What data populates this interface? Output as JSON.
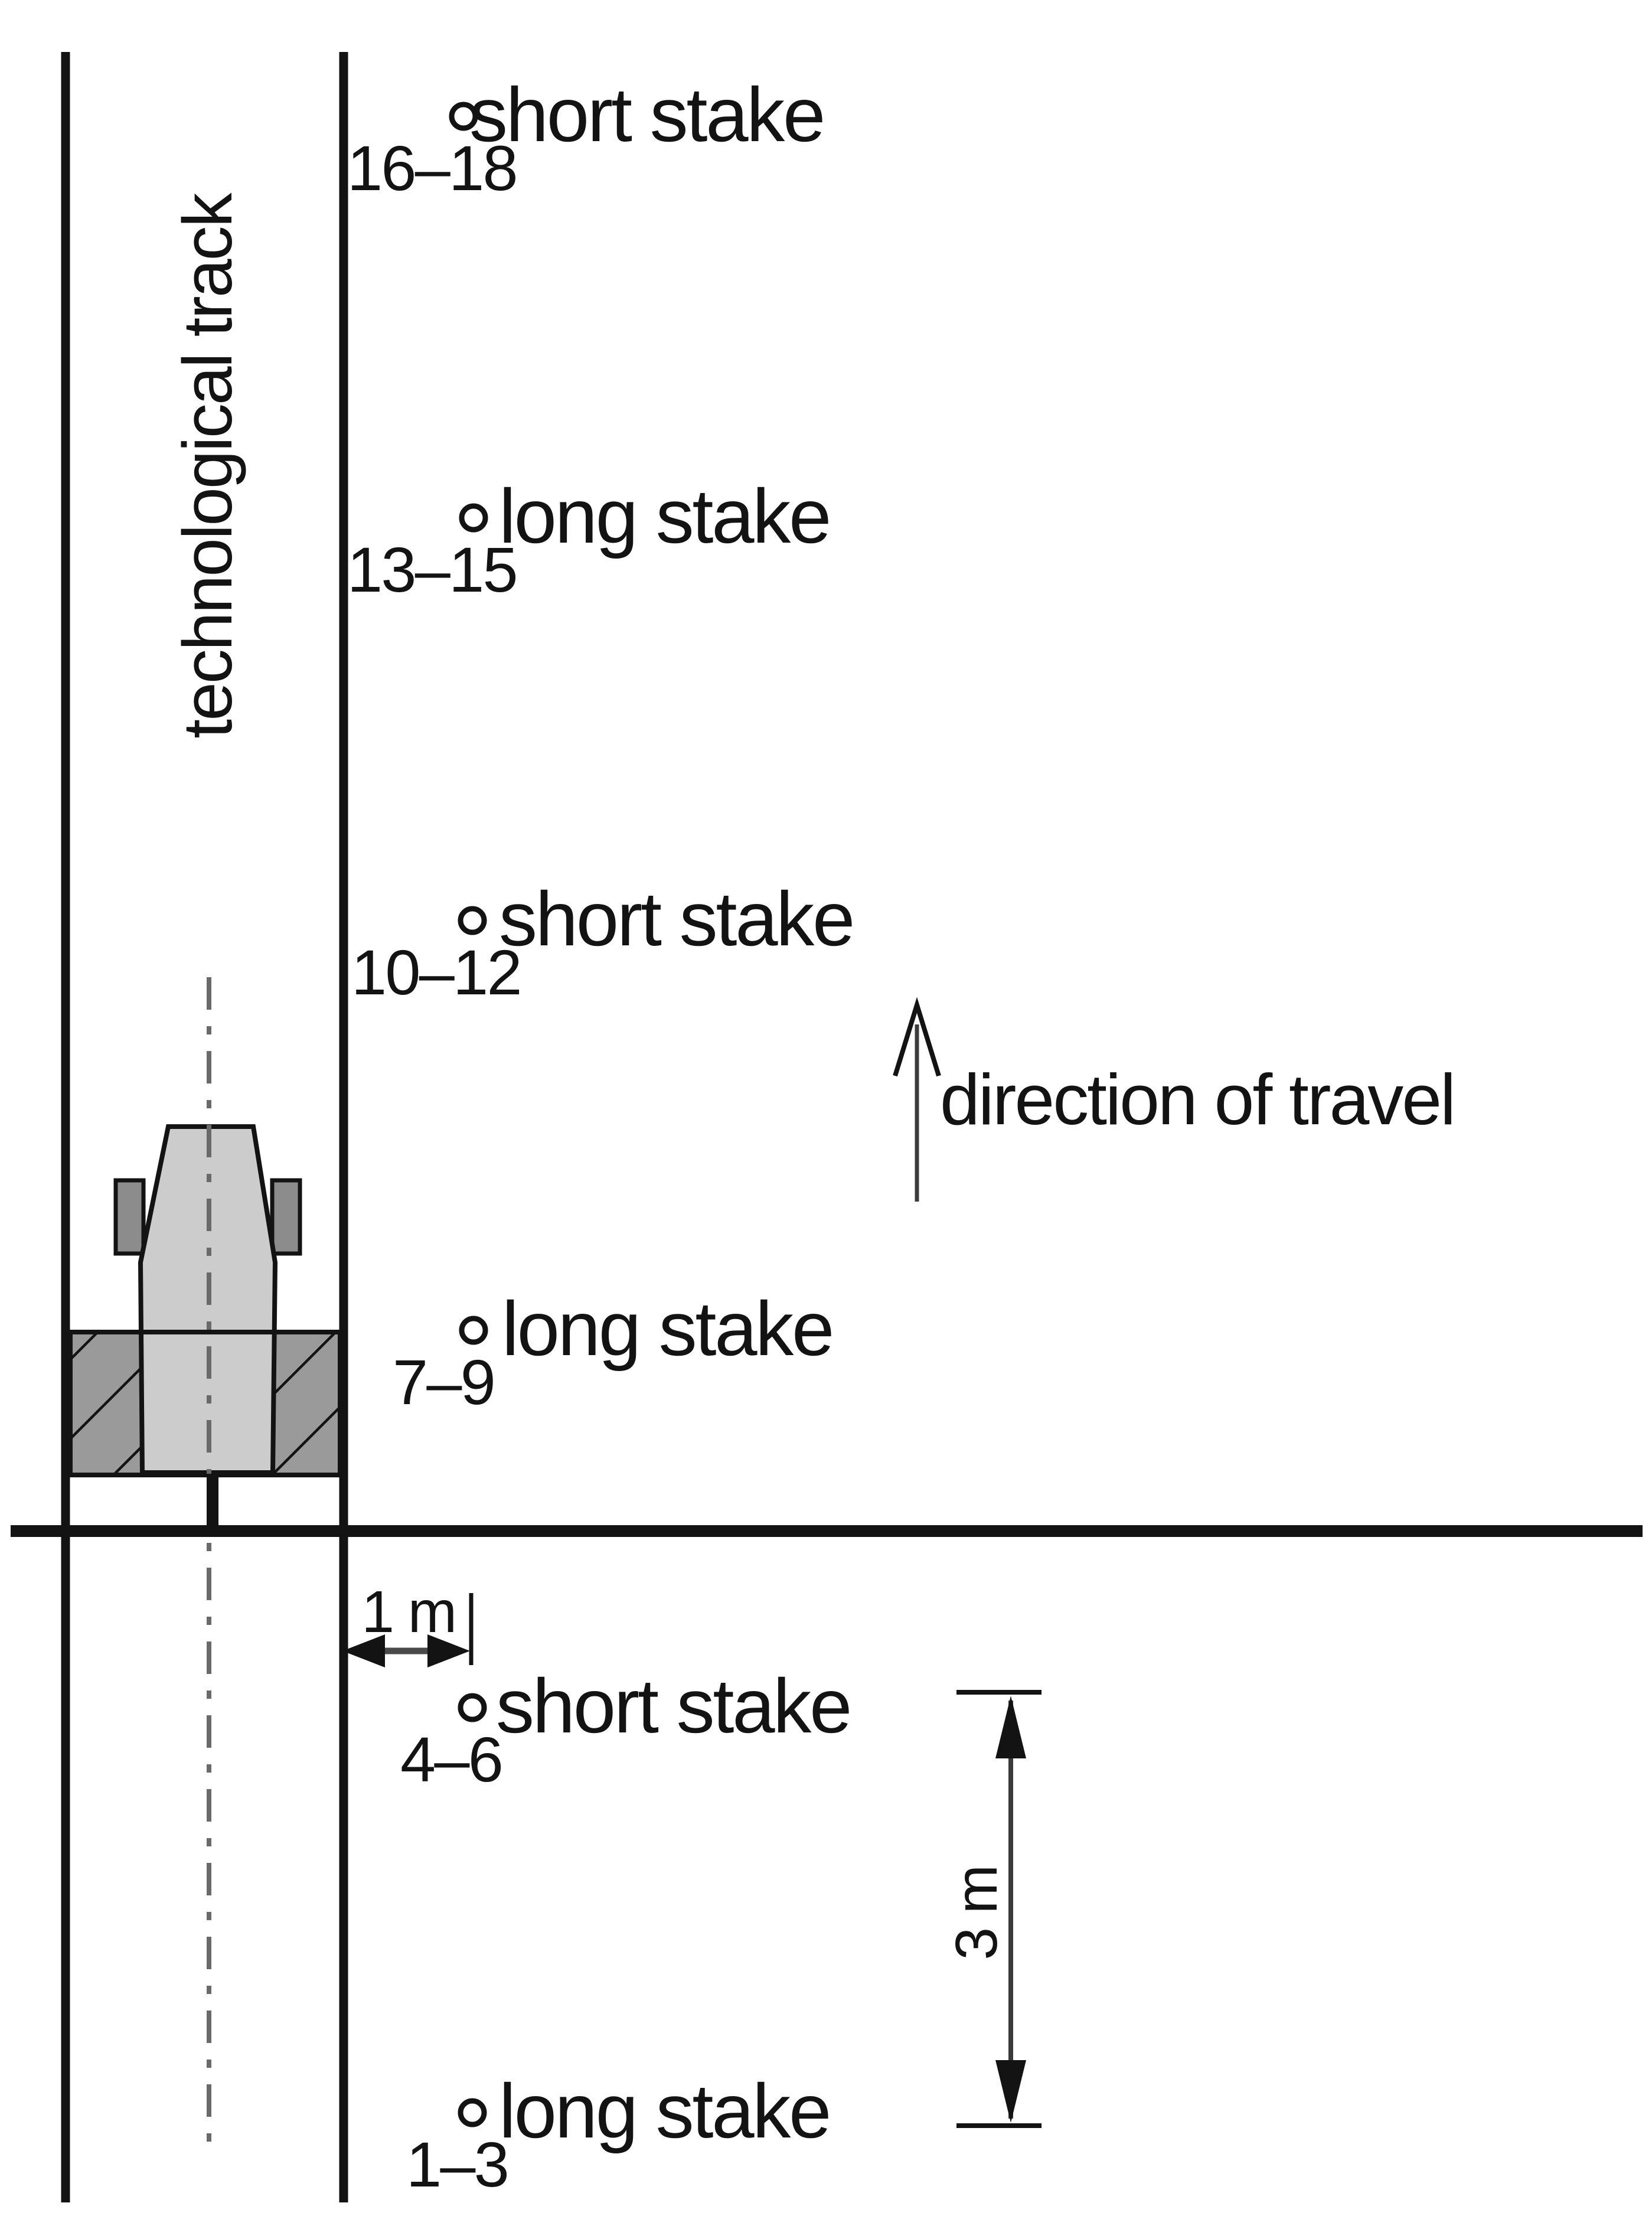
{
  "diagram": {
    "track_label": "technological track",
    "direction_label": "direction of travel",
    "dimension_1m_label": "1 m",
    "dimension_3m_label": "3 m",
    "stakes": [
      {
        "range": "16–18",
        "type": "short stake"
      },
      {
        "range": "13–15",
        "type": "long stake"
      },
      {
        "range": "10–12",
        "type": "short stake"
      },
      {
        "range": "7–9",
        "type": "long stake"
      },
      {
        "range": "4–6",
        "type": "short stake"
      },
      {
        "range": "1–3",
        "type": "long stake"
      }
    ],
    "colors": {
      "ink": "#131313",
      "line_gray": "#4a4a4a",
      "tractor_body": "#cccccc",
      "tractor_wheel": "#8c8c8c",
      "implement_fill": "#9a9a9a",
      "background": "#ffffff"
    }
  }
}
